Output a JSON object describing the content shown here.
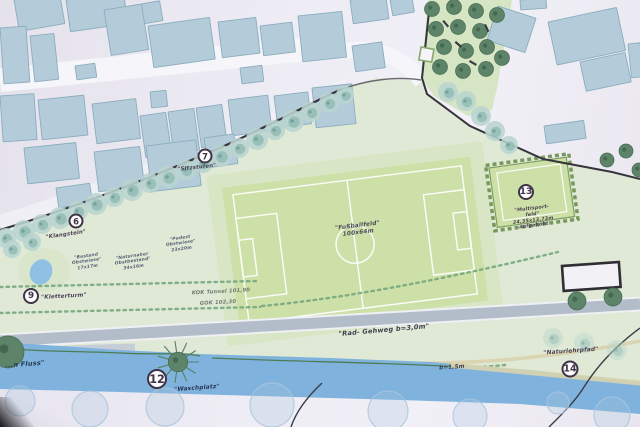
{
  "plan": {
    "type": "landscape-site-plan",
    "field": {
      "label_lines": [
        "\"Fußballfeld\"",
        "100x64m"
      ]
    },
    "colors": {
      "paper": "#ebe8f1",
      "building": "#b4ccd9",
      "building_edge": "#8aadbe",
      "park": "#dfe9d6",
      "orchard": "#d6e5c3",
      "field": "#cde0a8",
      "apron": "#d7e4bf",
      "line_white": "#ffffff",
      "water": "#7fb3dd",
      "wall": "#35343a",
      "street_tree": "#b9d4cf",
      "street_tree_core": "#8fb9b2",
      "dark_tree": "#5d8468",
      "path_gray": "#b3bdc9",
      "path_tan": "#d9d3ae",
      "dash_green": "#76a87e",
      "bank_line": "#4e7d55",
      "marker_ring": "#3f3347",
      "bank_tree": "#a9c4df",
      "road": "#f6f5f9"
    },
    "markers": [
      {
        "num": "6",
        "x": 76,
        "y": 221,
        "d": 15
      },
      {
        "num": "7",
        "x": 205,
        "y": 156,
        "d": 15
      },
      {
        "num": "9",
        "x": 31,
        "y": 296,
        "d": 16
      },
      {
        "num": "12",
        "x": 157,
        "y": 379,
        "d": 20
      },
      {
        "num": "13",
        "x": 526,
        "y": 192,
        "d": 16
      },
      {
        "num": "14",
        "x": 570,
        "y": 369,
        "d": 17
      }
    ],
    "labels": [
      {
        "name": "label-klangstein",
        "lines": [
          "\"Klangstein\""
        ],
        "x": 66,
        "y": 235,
        "r": -8,
        "s": 5.4,
        "c": "#4a3f54"
      },
      {
        "name": "label-sitzstufen",
        "lines": [
          "\"Sitzstufen\""
        ],
        "x": 197,
        "y": 168,
        "r": -6,
        "s": 5.4,
        "c": "#4a3f54"
      },
      {
        "name": "label-kletterturm",
        "lines": [
          "\"Kletterturm\""
        ],
        "x": 64,
        "y": 297,
        "r": -3,
        "s": 5.6,
        "c": "#4a3f54"
      },
      {
        "name": "label-waschplatz",
        "lines": [
          "\"Waschplatz\""
        ],
        "x": 197,
        "y": 389,
        "r": -4,
        "s": 5.8,
        "c": "#2c3550"
      },
      {
        "name": "label-naturlehrpfad",
        "lines": [
          "\"Naturlehrpfad\""
        ],
        "x": 571,
        "y": 352,
        "r": -4,
        "s": 5.8,
        "c": "#4a3f54"
      },
      {
        "name": "label-multisportfeld",
        "lines": [
          "\"Multisport-",
          "feld\"",
          "24,35x13,73m",
          "aufgehöht"
        ],
        "x": 533,
        "y": 218,
        "r": -7,
        "s": 4.8,
        "c": "#4a3f54"
      },
      {
        "name": "label-fussballfeld",
        "lines": [
          "\"Fußballfeld\"",
          "100x64m"
        ],
        "x": 358,
        "y": 230,
        "r": -7,
        "s": 5.8,
        "c": "#4e4a58"
      },
      {
        "name": "label-obstwiese-1",
        "lines": [
          "\"Bestand",
          "Obstwiese\"",
          "17x17m"
        ],
        "x": 87,
        "y": 262,
        "r": -8,
        "s": 4.4,
        "c": "#596274"
      },
      {
        "name": "label-obstwiese-2",
        "lines": [
          "\"Naturnaher",
          "Obstbestand\"",
          "34x16m"
        ],
        "x": 133,
        "y": 262,
        "r": -8,
        "s": 4.4,
        "c": "#596274"
      },
      {
        "name": "label-obstwiese-3",
        "lines": [
          "\"Podest",
          "Obstwiese\"",
          "23x20m"
        ],
        "x": 181,
        "y": 244,
        "r": -8,
        "s": 4.4,
        "c": "#596274"
      },
      {
        "name": "label-kok-tunnel",
        "lines": [
          "KOK Tunnel 101,90"
        ],
        "x": 221,
        "y": 292,
        "r": -3,
        "s": 5.2,
        "c": "#6e7c6e"
      },
      {
        "name": "label-gok",
        "lines": [
          "GOK 102,30"
        ],
        "x": 218,
        "y": 303,
        "r": -3,
        "s": 5.2,
        "c": "#6e7c6e"
      },
      {
        "name": "label-rad-gehweg",
        "lines": [
          "\"Rad- Gehweg b=3,0m\""
        ],
        "x": 384,
        "y": 331,
        "r": -5,
        "s": 6.6,
        "c": "#3f3f4b"
      },
      {
        "name": "label-b15",
        "lines": [
          "b=1,5m"
        ],
        "x": 452,
        "y": 368,
        "r": -4,
        "s": 5.6,
        "c": "#3f3f4b"
      },
      {
        "name": "label-fluss",
        "lines": [
          "...n Fluss\""
        ],
        "x": 25,
        "y": 365,
        "r": -4,
        "s": 6.6,
        "c": "#273a58"
      }
    ],
    "buildings": [
      [
        14,
        0,
        46,
        32,
        -10
      ],
      [
        66,
        0,
        58,
        32,
        -8
      ],
      [
        130,
        6,
        30,
        20,
        -10
      ],
      [
        0,
        28,
        26,
        56,
        -4
      ],
      [
        30,
        36,
        24,
        46,
        -6
      ],
      [
        104,
        10,
        38,
        46,
        -9
      ],
      [
        148,
        26,
        62,
        42,
        -8
      ],
      [
        218,
        22,
        38,
        36,
        -7
      ],
      [
        260,
        26,
        32,
        30,
        -7
      ],
      [
        298,
        16,
        44,
        46,
        -6
      ],
      [
        350,
        0,
        36,
        24,
        -8
      ],
      [
        390,
        0,
        22,
        16,
        -10
      ],
      [
        352,
        46,
        30,
        26,
        -8
      ],
      [
        240,
        68,
        22,
        16,
        -7
      ],
      [
        75,
        66,
        20,
        14,
        -8
      ],
      [
        0,
        96,
        34,
        46,
        -4
      ],
      [
        38,
        100,
        46,
        40,
        -6
      ],
      [
        92,
        104,
        44,
        40,
        -7
      ],
      [
        140,
        116,
        26,
        42,
        -8
      ],
      [
        168,
        112,
        26,
        42,
        -8
      ],
      [
        196,
        108,
        26,
        40,
        -8
      ],
      [
        228,
        100,
        40,
        36,
        -7
      ],
      [
        274,
        96,
        34,
        32,
        -7
      ],
      [
        312,
        88,
        40,
        40,
        -6
      ],
      [
        150,
        92,
        16,
        16,
        -6
      ],
      [
        24,
        148,
        52,
        36,
        -6
      ],
      [
        94,
        152,
        46,
        40,
        -7
      ],
      [
        146,
        146,
        50,
        46,
        -7
      ],
      [
        204,
        138,
        30,
        30,
        -8
      ],
      [
        56,
        188,
        34,
        20,
        -8
      ],
      [
        498,
        6,
        40,
        36,
        18
      ],
      [
        548,
        22,
        70,
        44,
        -12
      ],
      [
        580,
        62,
        46,
        30,
        -12
      ],
      [
        544,
        126,
        40,
        18,
        -8
      ],
      [
        628,
        44,
        12,
        34,
        -6
      ],
      [
        520,
        0,
        26,
        10,
        -4
      ]
    ],
    "street_trees": [
      [
        6,
        238,
        10
      ],
      [
        24,
        231,
        11
      ],
      [
        42,
        224,
        10
      ],
      [
        60,
        218,
        11
      ],
      [
        78,
        211,
        10
      ],
      [
        96,
        204,
        11
      ],
      [
        114,
        197,
        10
      ],
      [
        132,
        190,
        11
      ],
      [
        150,
        183,
        10
      ],
      [
        168,
        177,
        11
      ],
      [
        186,
        170,
        10
      ],
      [
        203,
        163,
        10
      ],
      [
        221,
        156,
        11
      ],
      [
        239,
        148,
        10
      ],
      [
        257,
        139,
        11
      ],
      [
        275,
        130,
        10
      ],
      [
        293,
        121,
        11
      ],
      [
        311,
        112,
        10
      ],
      [
        329,
        103,
        10
      ],
      [
        345,
        95,
        9
      ],
      [
        448,
        92,
        10
      ],
      [
        466,
        101,
        10
      ],
      [
        481,
        116,
        10
      ],
      [
        495,
        131,
        10
      ],
      [
        509,
        145,
        9
      ],
      [
        12,
        249,
        9
      ],
      [
        32,
        242,
        9
      ]
    ],
    "faint_trees": [
      [
        553,
        338,
        10
      ],
      [
        584,
        343,
        10
      ],
      [
        617,
        350,
        10
      ]
    ],
    "orchard_trees": [
      [
        432,
        9
      ],
      [
        454,
        7
      ],
      [
        476,
        11
      ],
      [
        497,
        15
      ],
      [
        436,
        29
      ],
      [
        458,
        27
      ],
      [
        480,
        31
      ],
      [
        444,
        47
      ],
      [
        466,
        51
      ],
      [
        487,
        47
      ],
      [
        440,
        67
      ],
      [
        463,
        71
      ],
      [
        486,
        69
      ],
      [
        502,
        58
      ]
    ],
    "dark_trees": [
      [
        607,
        160,
        7
      ],
      [
        626,
        151,
        7
      ],
      [
        639,
        170,
        7
      ],
      [
        577,
        301,
        9
      ],
      [
        613,
        297,
        9
      ],
      [
        8,
        352,
        16
      ]
    ],
    "wasch_tree": [
      178,
      362,
      13
    ],
    "bank_trees": [
      [
        20,
        401,
        15
      ],
      [
        90,
        409,
        18
      ],
      [
        165,
        407,
        19
      ],
      [
        272,
        405,
        22
      ],
      [
        388,
        411,
        20
      ],
      [
        470,
        416,
        17
      ],
      [
        558,
        403,
        11
      ],
      [
        612,
        415,
        18
      ]
    ],
    "benches": [
      [
        444,
        20,
        50
      ],
      [
        456,
        41,
        40
      ],
      [
        470,
        60,
        30
      ],
      [
        486,
        24,
        65
      ]
    ]
  }
}
